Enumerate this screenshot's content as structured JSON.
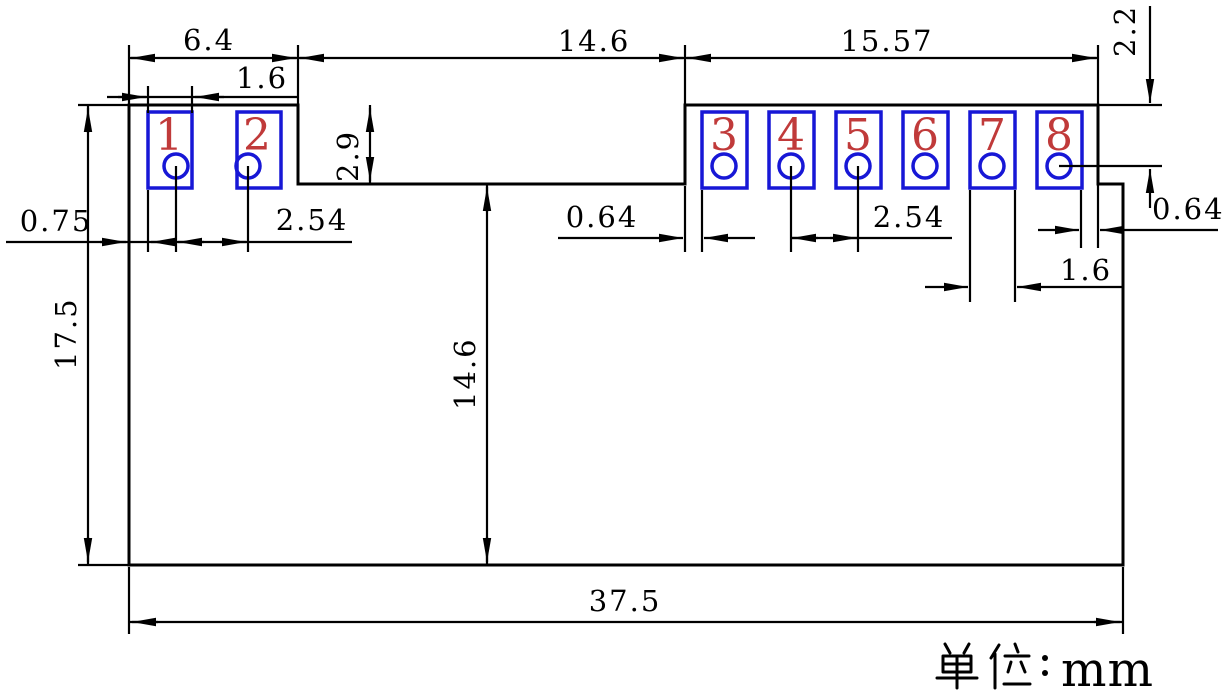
{
  "drawing": {
    "units_label": {
      "full": "单位：mm",
      "prefix": "单位",
      "separator": "：",
      "unit": "mm"
    },
    "pads": {
      "count": 8,
      "numbers": [
        "1",
        "2",
        "3",
        "4",
        "5",
        "6",
        "7",
        "8"
      ]
    },
    "dimensions": {
      "left_tab_width": "6.4",
      "pad1_width": "1.6",
      "top_notch_width": "14.6",
      "right_tab_width": "15.57",
      "hole_row_offset": "2.2",
      "notch_depth": "2.9",
      "left_edge_to_pad1": "0.75",
      "pads_1_2_pitch": "2.54",
      "tab_edge_to_pad3_gap": "0.64",
      "pads_4_5_pitch": "2.54",
      "pad8_to_tab_edge_gap": "0.64",
      "pad7_width": "1.6",
      "overall_height": "17.5",
      "lower_body_height": "14.6",
      "overall_width": "37.5"
    },
    "colors": {
      "line": "#000000",
      "pad_outline": "#1717d6",
      "pad_number": "#c03a3a",
      "background": "#ffffff"
    }
  }
}
